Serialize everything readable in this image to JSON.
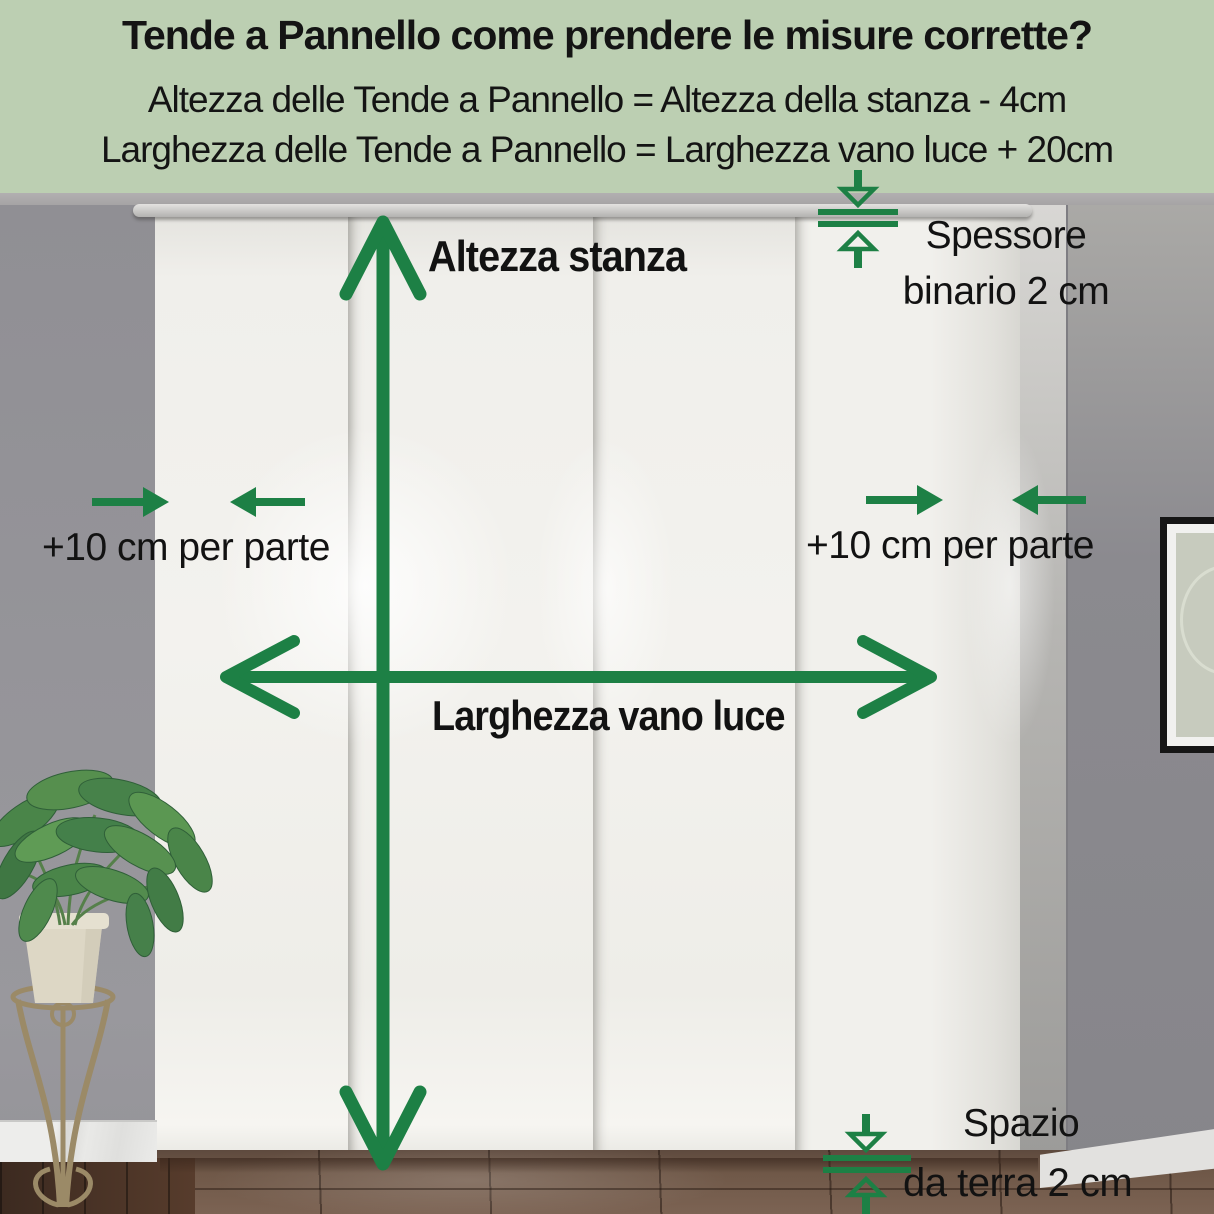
{
  "header": {
    "title": "Tende a Pannello come prendere le misure corrette?",
    "formula_height": "Altezza delle Tende a Pannello = Altezza della stanza - 4cm",
    "formula_width": "Larghezza delle Tende a Pannello = Larghezza vano luce + 20cm",
    "bg_color": "#bccfb2",
    "text_color": "#141414"
  },
  "annotations": {
    "arrow_color": "#1d8045",
    "room_height": {
      "label": "Altezza stanza"
    },
    "opening_width": {
      "label": "Larghezza vano luce"
    },
    "side_margin_left": {
      "label": "+10 cm per parte"
    },
    "side_margin_right": {
      "label": "+10 cm per parte"
    },
    "track_thickness": {
      "line1": "Spessore",
      "line2": "binario 2 cm"
    },
    "floor_gap": {
      "line1": "Spazio",
      "line2": "da terra 2 cm"
    }
  },
  "scene": {
    "curtain_panel_count": 4
  }
}
